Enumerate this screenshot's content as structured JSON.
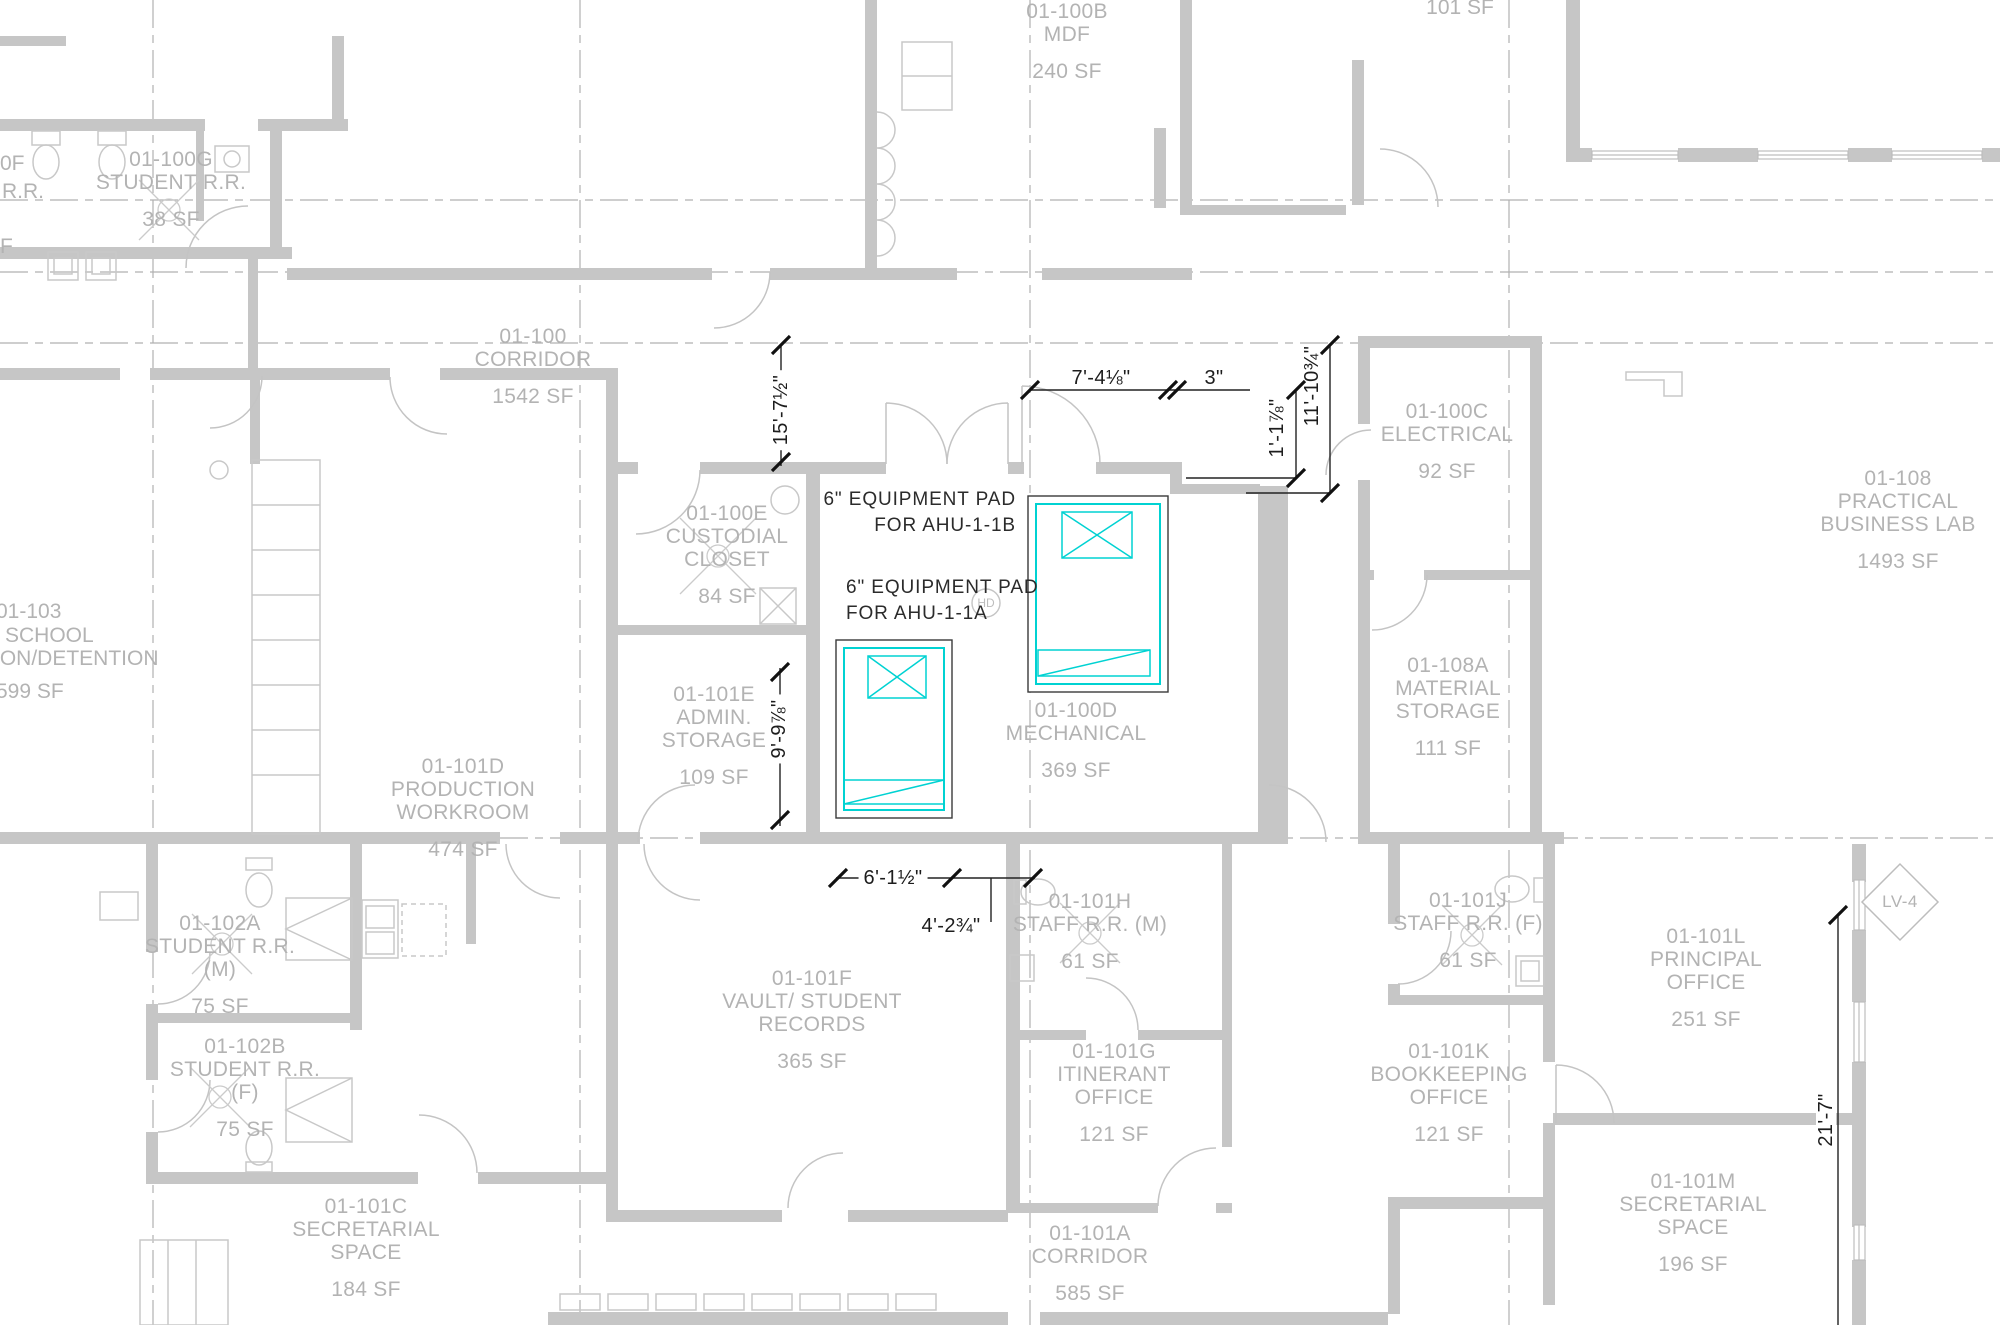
{
  "rooms": [
    {
      "id": "01-100b",
      "lines": [
        "01-100B",
        "MDF"
      ],
      "sf": "240 SF",
      "cx": 1067,
      "y": 0
    },
    {
      "id": "01-100g",
      "lines": [
        "01-100G",
        "STUDENT R.R."
      ],
      "sf": "38 SF",
      "cx": 171,
      "y": 148
    },
    {
      "id": "01-100-corridor",
      "lines": [
        "01-100",
        "CORRIDOR"
      ],
      "sf": "1542 SF",
      "cx": 533,
      "y": 325
    },
    {
      "id": "01-100c",
      "lines": [
        "01-100C",
        "ELECTRICAL"
      ],
      "sf": "92 SF",
      "cx": 1447,
      "y": 400
    },
    {
      "id": "01-108",
      "lines": [
        "01-108",
        "PRACTICAL",
        "BUSINESS LAB"
      ],
      "sf": "1493 SF",
      "cx": 1898,
      "y": 467
    },
    {
      "id": "01-100e",
      "lines": [
        "01-100E",
        "CUSTODIAL",
        "CLOSET"
      ],
      "sf": "84 SF",
      "cx": 727,
      "y": 502
    },
    {
      "id": "01-101e",
      "lines": [
        "01-101E",
        "ADMIN.",
        "STORAGE"
      ],
      "sf": "109 SF",
      "cx": 714,
      "y": 683
    },
    {
      "id": "01-101d",
      "lines": [
        "01-101D",
        "PRODUCTION",
        "WORKROOM"
      ],
      "sf": "474 SF",
      "cx": 463,
      "y": 755
    },
    {
      "id": "01-100d",
      "lines": [
        "01-100D",
        "MECHANICAL"
      ],
      "sf": "369 SF",
      "cx": 1076,
      "y": 699
    },
    {
      "id": "01-108a",
      "lines": [
        "01-108A",
        "MATERIAL",
        "STORAGE"
      ],
      "sf": "111 SF",
      "cx": 1448,
      "y": 654
    },
    {
      "id": "01-102a",
      "lines": [
        "01-102A",
        "STUDENT R.R.",
        "(M)"
      ],
      "sf": "75 SF",
      "cx": 220,
      "y": 912
    },
    {
      "id": "01-102b",
      "lines": [
        "01-102B",
        "STUDENT R.R.",
        "(F)"
      ],
      "sf": "75 SF",
      "cx": 245,
      "y": 1035
    },
    {
      "id": "01-101h",
      "lines": [
        "01-101H",
        "STAFF R.R. (M)"
      ],
      "sf": "61 SF",
      "cx": 1090,
      "y": 890
    },
    {
      "id": "01-101j",
      "lines": [
        "01-101J",
        "STAFF R.R. (F)"
      ],
      "sf": "61 SF",
      "cx": 1468,
      "y": 889
    },
    {
      "id": "01-101f",
      "lines": [
        "01-101F",
        "VAULT/ STUDENT",
        "RECORDS"
      ],
      "sf": "365 SF",
      "cx": 812,
      "y": 967
    },
    {
      "id": "01-101g",
      "lines": [
        "01-101G",
        "ITINERANT",
        "OFFICE"
      ],
      "sf": "121 SF",
      "cx": 1114,
      "y": 1040
    },
    {
      "id": "01-101k",
      "lines": [
        "01-101K",
        "BOOKKEEPING",
        "OFFICE"
      ],
      "sf": "121 SF",
      "cx": 1449,
      "y": 1040
    },
    {
      "id": "01-101l",
      "lines": [
        "01-101L",
        "PRINCIPAL",
        "OFFICE"
      ],
      "sf": "251 SF",
      "cx": 1706,
      "y": 925
    },
    {
      "id": "01-101m",
      "lines": [
        "01-101M",
        "SECRETARIAL",
        "SPACE"
      ],
      "sf": "196 SF",
      "cx": 1693,
      "y": 1170
    },
    {
      "id": "01-101a",
      "lines": [
        "01-101A",
        "CORRIDOR"
      ],
      "sf": "585 SF",
      "cx": 1090,
      "y": 1222
    },
    {
      "id": "01-101c",
      "lines": [
        "01-101C",
        "SECRETARIAL",
        "SPACE"
      ],
      "sf": "184 SF",
      "cx": 366,
      "y": 1195
    }
  ],
  "fragments": [
    {
      "text": "101 SF",
      "cx": 1460,
      "y": -4
    },
    {
      "text": "0F",
      "x": 0,
      "y": 152
    },
    {
      "text": "R.R.",
      "x": 2,
      "y": 180
    },
    {
      "text": "F",
      "x": 0,
      "y": 235
    },
    {
      "text": "01-103",
      "x": -4,
      "y": 600
    },
    {
      "text": "SCHOOL",
      "x": 5,
      "y": 624
    },
    {
      "text": "ION/DETENTION",
      "x": -6,
      "y": 647
    },
    {
      "text": "599 SF",
      "x": -4,
      "y": 680
    }
  ],
  "dimensions": [
    {
      "text": "15'-7½\"",
      "cx": 781,
      "cy": 410,
      "rot": 1,
      "bg": 1
    },
    {
      "text": "7'-4⅛\"",
      "cx": 1101,
      "cy": 378
    },
    {
      "text": "3\"",
      "cx": 1214,
      "cy": 378
    },
    {
      "text": "1'-1⅞\"",
      "cx": 1277,
      "cy": 428,
      "rot": 1
    },
    {
      "text": "11'-10¾\"",
      "cx": 1312,
      "cy": 386,
      "rot": 1
    },
    {
      "text": "9'-9⅞\"",
      "cx": 779,
      "cy": 729,
      "rot": 1,
      "bg": 1
    },
    {
      "text": "6'-1½\"",
      "cx": 893,
      "cy": 878,
      "bg": 1
    },
    {
      "text": "4'-2¾\"",
      "cx": 951,
      "cy": 926
    },
    {
      "text": "21'-7\"",
      "cx": 1826,
      "cy": 1120,
      "rot": 1,
      "bg": 1
    }
  ],
  "notes": [
    {
      "lines": [
        "6\" EQUIPMENT PAD",
        "FOR AHU-1-1B"
      ],
      "x": 1016,
      "y": 487,
      "align": "right"
    },
    {
      "lines": [
        "6\" EQUIPMENT PAD",
        "FOR AHU-1-1A"
      ],
      "x": 846,
      "y": 575,
      "align": "left"
    }
  ],
  "tag": {
    "text": "LV-4"
  },
  "hd_symbol": {
    "text": "HD"
  },
  "colors": {
    "wall": "#c6c6c6",
    "label": "#b3b3b3",
    "dimension": "#1d1d1d",
    "pad_cyan": "#00d2d2",
    "grid": "#b0b0b0"
  }
}
